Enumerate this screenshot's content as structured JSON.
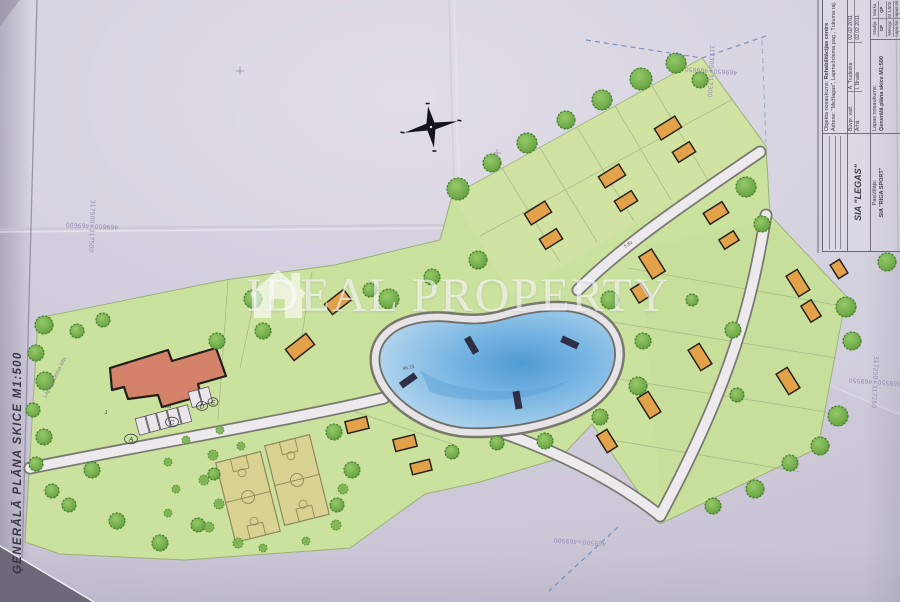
{
  "watermark": {
    "left": "IDEAL",
    "right": "PROPERTY",
    "icon": "house-icon"
  },
  "sheet": {
    "side_title": "ĢENERĀLĀ PLĀNA SKICE M1:500"
  },
  "plan": {
    "street_label": "Lapmežciema iela",
    "pond_elevation": "96.25",
    "dim_label": "5.82",
    "parking": {
      "letters": [
        "A",
        "C",
        "D",
        "E"
      ],
      "row_number": "1",
      "note": "N.M"
    }
  },
  "coords": {
    "top_right": {
      "h": "469650+469650",
      "v": "317300+317300"
    },
    "left": {
      "h": "469600+469600",
      "v": "317500+317500"
    },
    "right": {
      "h": "469550+469550",
      "v": "317250+317250"
    },
    "bottom": {
      "h": "469500+469500"
    }
  },
  "title_block": {
    "object_label": "Objekta nosaukums:",
    "object": "Rehabilitācijas centrs",
    "address_label": "Adrese:",
    "address": "\"Mežlagas\", Lapmežciema pag., Tukuma raj.",
    "sheet_label": "Lapas nosaukums:",
    "sheet_name": "Ģenerālā plāna skice M1:500",
    "company": "SIA \"LEGAS\"",
    "client_label": "Pasūtītājs:",
    "client": "SIA \"RIGA SPORT\"",
    "rows": [
      {
        "role": "Būvpr. vad.",
        "name": "A. Trudeska",
        "date": "02.02.2011"
      },
      {
        "role": "Arhit.",
        "name": "I. Brade",
        "date": "02.02.2011"
      }
    ],
    "stadija_label": "Stadija",
    "stadija": "GP",
    "marka_label": "Marka",
    "marka": "ĢP",
    "scale_label": "Mērogs",
    "scale": "M 1:500",
    "page_label": "Lapa Nr.",
    "pages_label": "Lapas sk."
  },
  "colors": {
    "paper": "#d7d4e1",
    "site_green": "#cbe19e",
    "water": "#79b6e3",
    "house": "#e3a24a",
    "building_red": "#d5826b",
    "watermark_white": "rgba(255,255,255,0.6)"
  }
}
